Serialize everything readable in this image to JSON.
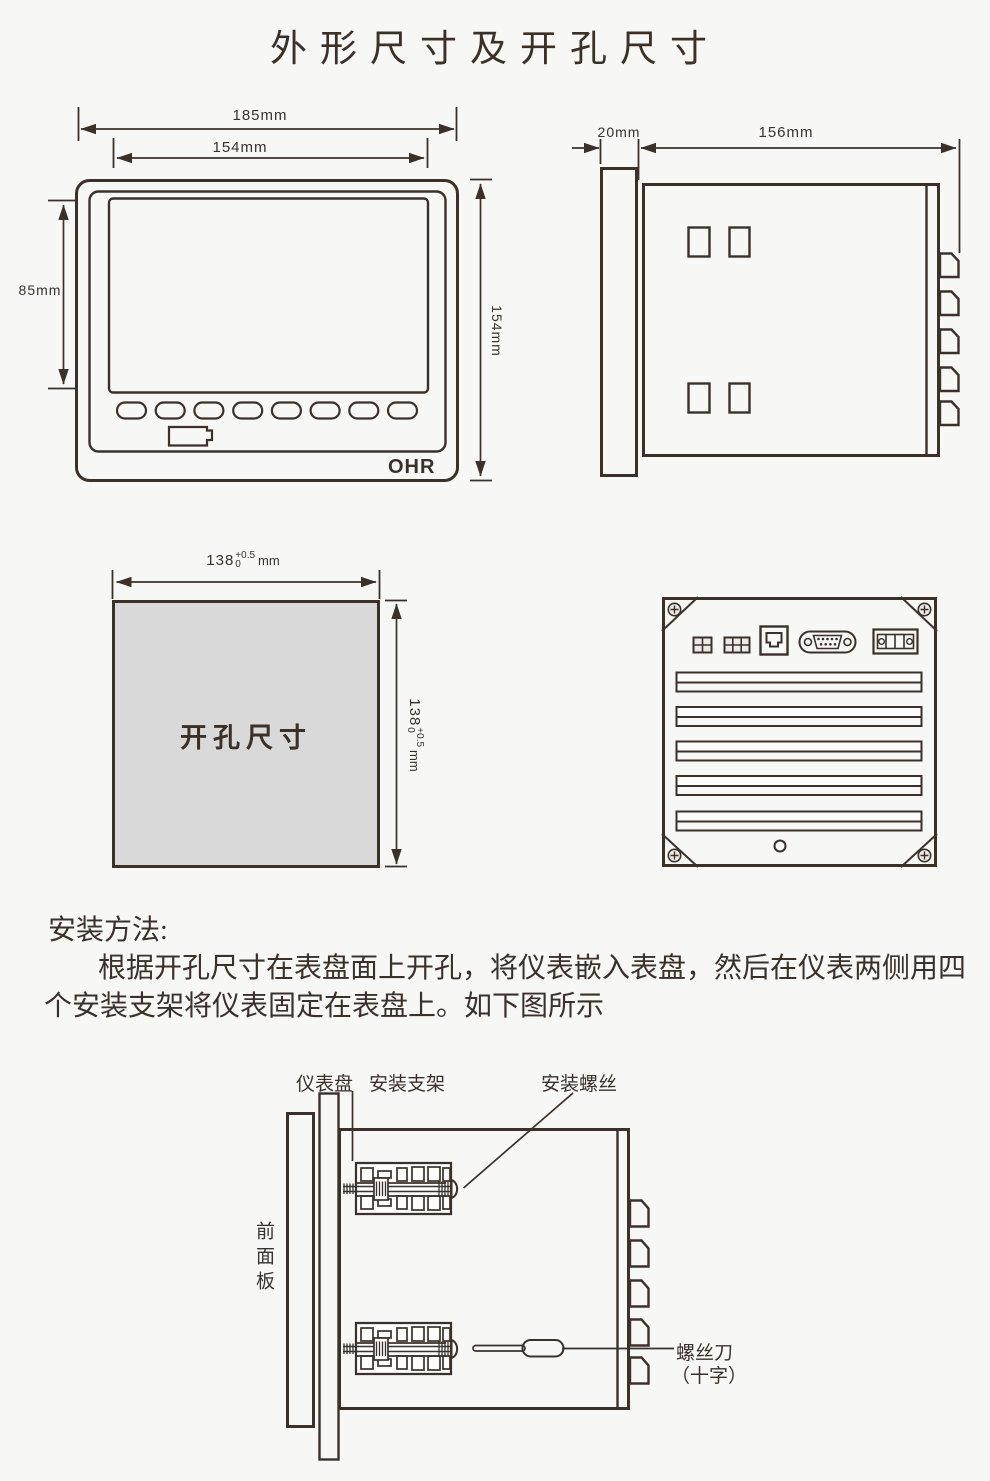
{
  "page": {
    "title": "外形尺寸及开孔尺寸"
  },
  "front_view": {
    "dim_width_outer": "185mm",
    "dim_width_inner": "154mm",
    "dim_height_screen": "85mm",
    "dim_height_outer": "154mm",
    "logo": "OHR"
  },
  "side_view": {
    "dim_depth_panel": "20mm",
    "dim_depth_body": "156mm"
  },
  "cutout": {
    "label": "开孔尺寸",
    "dim_value": "138",
    "tol_plus": "+0.5",
    "tol_minus": "0",
    "unit": "mm"
  },
  "install_text": {
    "heading": "安装方法:",
    "line1": "根据开孔尺寸在表盘面上开孔，将仪表嵌入表盘，然后在仪表两侧用四",
    "line2": "个安装支架将仪表固定在表盘上。如下图所示"
  },
  "install_diagram": {
    "label_panel": "仪表盘",
    "label_bracket": "安装支架",
    "label_screw": "安装螺丝",
    "label_front_panel": "前面板",
    "label_screwdriver": "螺丝刀",
    "label_screwdriver_type": "（十字）"
  },
  "colors": {
    "line": "#3a312b",
    "cutout_fill": "#d9d9d9",
    "bg": "#f7f7f6"
  }
}
